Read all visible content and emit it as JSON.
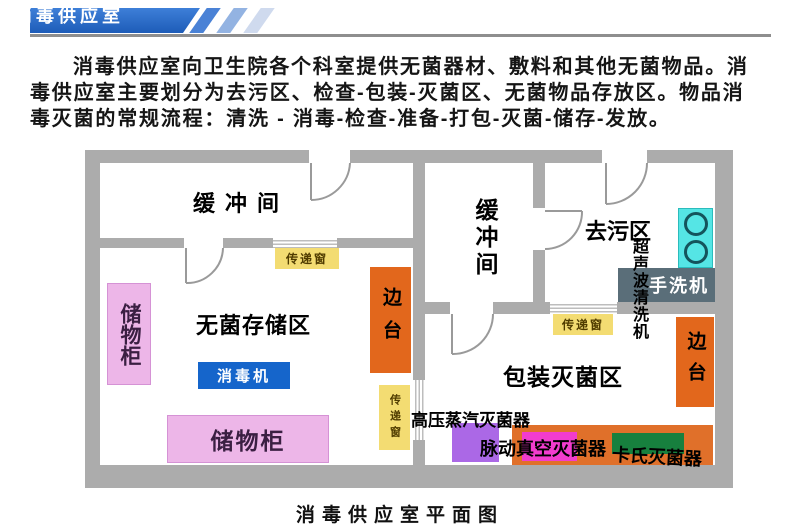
{
  "page": {
    "banner_title": "消毒供应室",
    "caption": "消毒供应室平面图"
  },
  "intro": {
    "text": "消毒供应室向卫生院各个科室提供无菌器材、敷料和其他无菌物品。消\n毒供应室主要划分为去污区、检查-包装-灭菌区、无菌物品存放区。物品消\n毒灭菌的常规流程：清洗 - 消毒-检查-准备-打包-灭菌-储存-发放。"
  },
  "floor_plan": {
    "rooms": {
      "buffer_left": "缓冲间",
      "buffer_right": "缓冲间",
      "sterile_storage": "无菌存储区",
      "decontamination": "去污区",
      "packing_sterilization": "包装灭菌区"
    },
    "equipment": {
      "storage_cabinet_left": "储物柜",
      "storage_cabinet_bottom": "储物柜",
      "disinfector": "消毒机",
      "side_table_left": "边台",
      "side_table_right": "边台",
      "pass_window_top": "传递窗",
      "pass_window_middle": "传递窗",
      "pass_window_right": "传递窗",
      "ultrasonic_cleaner": "超声波清洗机",
      "hand_washer": "手洗机",
      "autoclave": "高压蒸汽灭菌器",
      "pulse_vacuum_sterilizer": "脉动真空灭菌器",
      "cassette_sterilizer": "卡氏灭菌器"
    },
    "colors": {
      "wall_gray": "#acacac",
      "banner_blue": "#2368cc",
      "cabinet_pink": "#edb6e8",
      "side_table_orange": "#e2671c",
      "pass_window_yellow": "#f3dc72",
      "disinfector_blue": "#1565cb",
      "sink_cyan": "#55e5e5",
      "hand_washer_gray": "#5a6e79",
      "autoclave_purple": "#ab68e6",
      "sterilizer_orange": "#e0702a",
      "sterilizer_magenta": "#f23cce",
      "sterilizer_green": "#17803e"
    }
  }
}
